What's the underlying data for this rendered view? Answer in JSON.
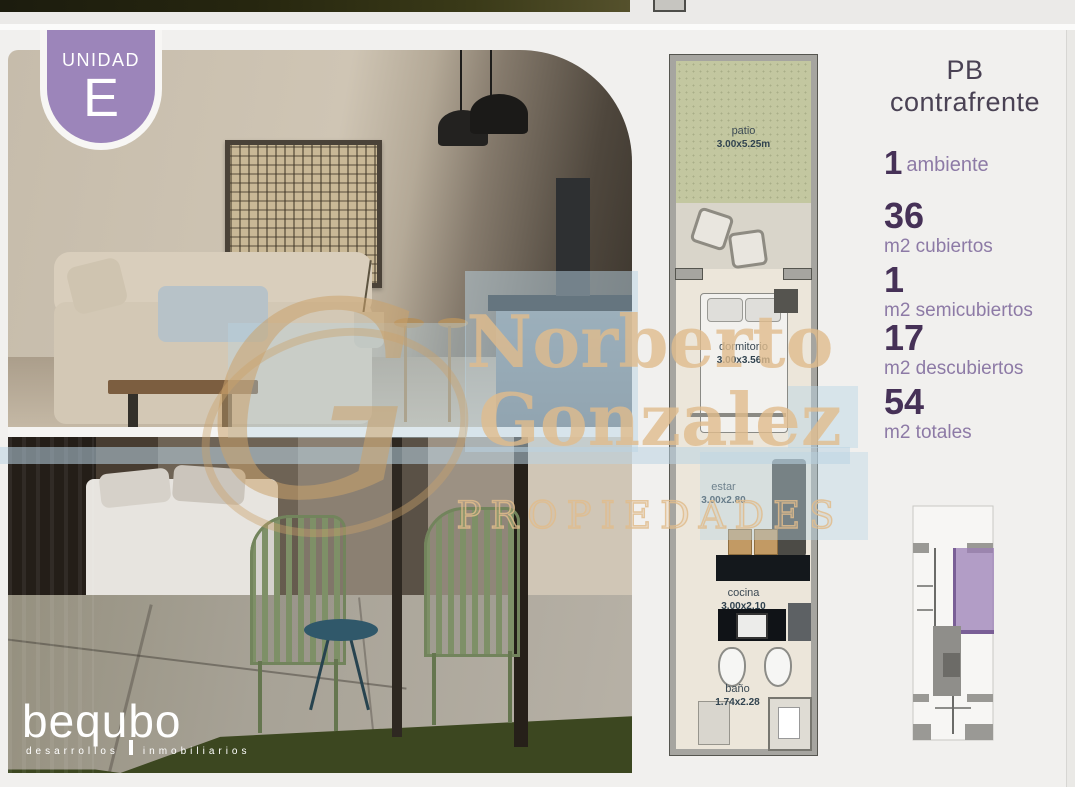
{
  "badge": {
    "label": "UNIDAD",
    "letter": "E"
  },
  "floor_title": {
    "line1": "PB",
    "line2": "contrafrente"
  },
  "stats": [
    {
      "value": "1",
      "label": "ambiente"
    },
    {
      "value": "36",
      "label": "m2 cubiertos"
    },
    {
      "value": "1",
      "label": "m2 semicubiertos"
    },
    {
      "value": "17",
      "label": "m2 descubiertos"
    },
    {
      "value": "54",
      "label": "m2 totales"
    }
  ],
  "floorplan": {
    "rooms": [
      {
        "name": "patio",
        "dims": "3.00x5.25m"
      },
      {
        "name": "dormitorio",
        "dims": "3.00x3.56m"
      },
      {
        "name": "estar",
        "dims": "3.00x2.80"
      },
      {
        "name": "cocina",
        "dims": "3.00x2.10"
      },
      {
        "name": "baño",
        "dims": "1.74x2.28"
      }
    ]
  },
  "watermark": {
    "monogram": "G",
    "line1": "Norberto",
    "line2": "Gonzalez",
    "line3": "PROPIEDADES"
  },
  "logo": {
    "name": "bequbo",
    "tagline_left": "desarrollos",
    "tagline_right": "inmobiliarios"
  },
  "colors": {
    "accent_purple": "#9c85ba",
    "stat_number": "#463157",
    "stat_label": "#8d7aa6",
    "floor_title_text": "#4a4254",
    "watermark_tan": "#e0bc8c",
    "watermark_blue": "#b9d4e4",
    "plan_grass": "#c3c7a0",
    "plan_background": "#ece6da",
    "keyplan_highlight": "#9b7fb7"
  }
}
